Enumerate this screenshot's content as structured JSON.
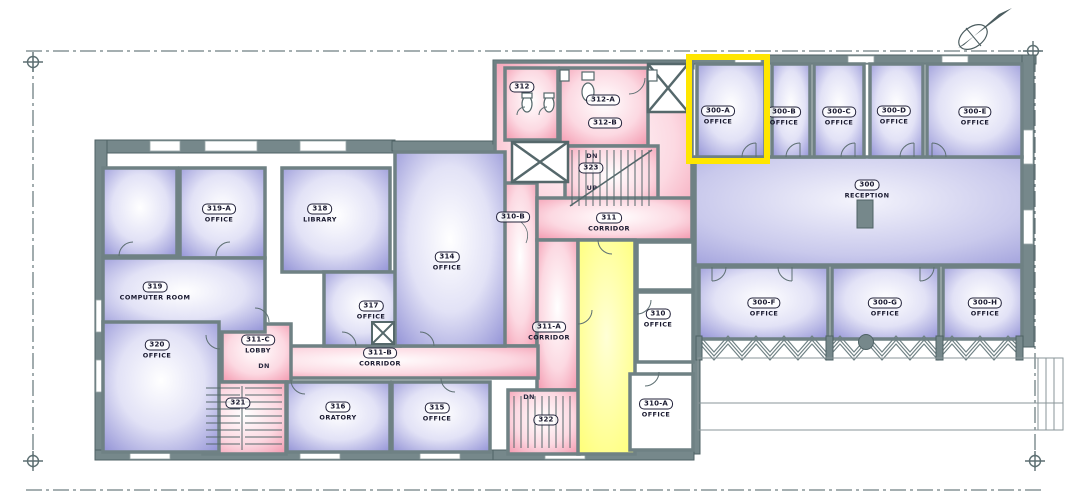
{
  "drawing": {
    "kind": "architectural third-floor plan",
    "wall_color": "#76888b",
    "office_fill": "#9393d8",
    "circulation_fill": "#f59cb2",
    "highlight_room_fill": "#ffff78",
    "background": "#ffffff"
  },
  "highlight": {
    "color": "#FFE600",
    "target_room": "300-A"
  },
  "rooms": [
    {
      "number": "319-A",
      "name": "OFFICE"
    },
    {
      "number": "318",
      "name": "LIBRARY"
    },
    {
      "number": "319",
      "name": "COMPUTER ROOM"
    },
    {
      "number": "320",
      "name": "OFFICE"
    },
    {
      "number": "311-C",
      "name": "LOBBY"
    },
    {
      "number": "321",
      "name": ""
    },
    {
      "number": "316",
      "name": "ORATORY"
    },
    {
      "number": "317",
      "name": "OFFICE"
    },
    {
      "number": "314",
      "name": "OFFICE"
    },
    {
      "number": "315",
      "name": "OFFICE"
    },
    {
      "number": "311-B",
      "name": "CORRIDOR"
    },
    {
      "number": "311-A",
      "name": "CORRIDOR"
    },
    {
      "number": "322",
      "name": ""
    },
    {
      "number": "312",
      "name": ""
    },
    {
      "number": "312-A",
      "name": ""
    },
    {
      "number": "312-B",
      "name": ""
    },
    {
      "number": "323",
      "name": ""
    },
    {
      "number": "310-B",
      "name": ""
    },
    {
      "number": "311",
      "name": "CORRIDOR"
    },
    {
      "number": "310",
      "name": "OFFICE"
    },
    {
      "number": "310-A",
      "name": "OFFICE"
    },
    {
      "number": "300-A",
      "name": "OFFICE"
    },
    {
      "number": "300-B",
      "name": "OFFICE"
    },
    {
      "number": "300-C",
      "name": "OFFICE"
    },
    {
      "number": "300-D",
      "name": "OFFICE"
    },
    {
      "number": "300-E",
      "name": "OFFICE"
    },
    {
      "number": "300",
      "name": "RECEPTION"
    },
    {
      "number": "300-F",
      "name": "OFFICE"
    },
    {
      "number": "300-G",
      "name": "OFFICE"
    },
    {
      "number": "300-H",
      "name": "OFFICE"
    }
  ],
  "annotations": {
    "down": "DN",
    "up": "UP"
  }
}
